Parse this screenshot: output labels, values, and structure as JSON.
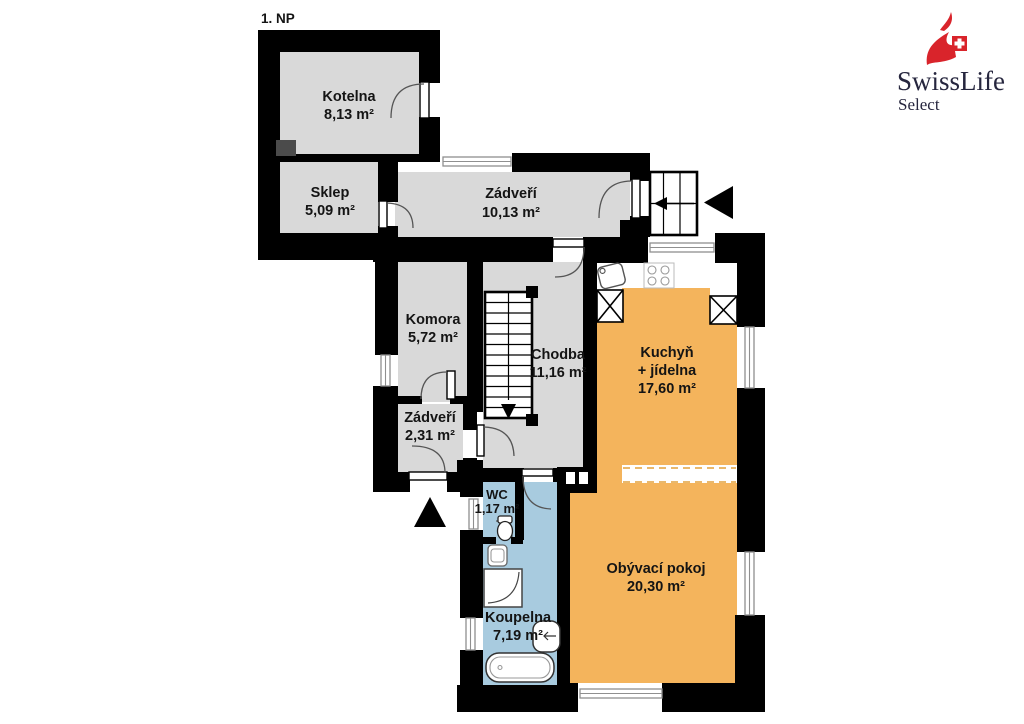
{
  "page": {
    "background": "#ffffff"
  },
  "plan": {
    "title": "1. NP",
    "colors": {
      "wall": "#000000",
      "room_gray": "#d9d9d9",
      "room_orange": "#f4b45c",
      "room_blue": "#a8cbdf",
      "dark_gray_block": "#4b4b4b",
      "window_frame": "#8f8f8f",
      "label_text": "#141414"
    },
    "rooms": [
      {
        "name": "Kotelna",
        "area": "8,13 m²",
        "color": "gray"
      },
      {
        "name": "Sklep",
        "area": "5,09 m²",
        "color": "gray"
      },
      {
        "name": "Zádveří",
        "area": "10,13 m²",
        "color": "gray"
      },
      {
        "name": "Komora",
        "area": "5,72 m²",
        "color": "gray"
      },
      {
        "name": "Chodba",
        "area": "11,16 m²",
        "color": "gray"
      },
      {
        "name": "Kuchyň",
        "name_line2": "+ jídelna",
        "area": "17,60 m²",
        "color": "orange"
      },
      {
        "name": "Zádveří",
        "area": "2,31 m²",
        "color": "gray"
      },
      {
        "name": "WC",
        "area": "1,17 m²",
        "color": "blue"
      },
      {
        "name": "Koupelna",
        "area": "7,19 m²",
        "color": "blue"
      },
      {
        "name": "Obývací pokoj",
        "area": "20,30 m²",
        "color": "orange"
      }
    ]
  },
  "logo": {
    "brand": "SwissLife",
    "subbrand": "Select",
    "accent": "#d9242b",
    "text_color": "#26263e"
  }
}
